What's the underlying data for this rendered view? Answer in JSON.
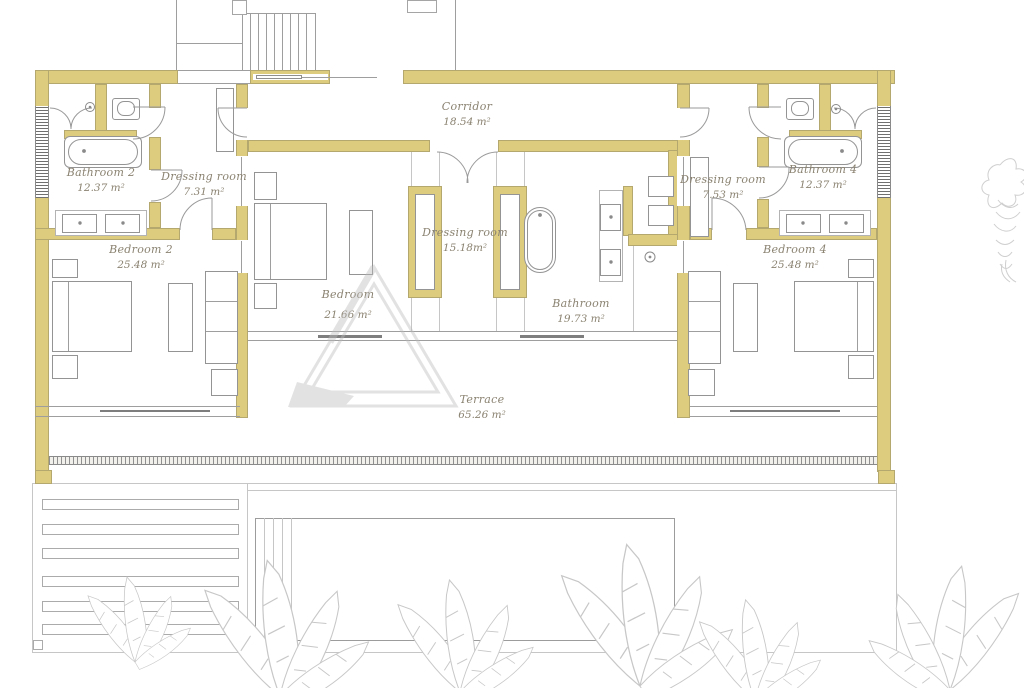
{
  "plan_title": "floor-plan",
  "rooms": [
    {
      "id": "corridor",
      "name": "Corridor",
      "area": "18.54 m²"
    },
    {
      "id": "bathroom-2",
      "name": "Bathroom 2",
      "area": "12.37 m²"
    },
    {
      "id": "dressing-room-2",
      "name": "Dressing room",
      "area": "7.31 m²"
    },
    {
      "id": "bedroom-2",
      "name": "Bedroom 2",
      "area": "25.48 m²"
    },
    {
      "id": "dressing-master",
      "name": "Dressing room",
      "area": "15.18m²"
    },
    {
      "id": "bedroom-3",
      "name": "Bedroom",
      "area": "21.66 m²"
    },
    {
      "id": "bathroom-master",
      "name": "Bathroom",
      "area": "19.73 m²"
    },
    {
      "id": "dressing-room-4",
      "name": "Dressing room",
      "area": "7.53 m²"
    },
    {
      "id": "bathroom-4",
      "name": "Bathroom 4",
      "area": "12.37 m²"
    },
    {
      "id": "bedroom-4",
      "name": "Bedroom 4",
      "area": "25.48 m²"
    },
    {
      "id": "terrace",
      "name": "Terrace",
      "area": "65.26 m²"
    }
  ],
  "colors": {
    "wall_fill": "#ddcb7e",
    "wall_edge": "#b5a86f",
    "drawing_line": "#9a9a9a",
    "label_text": "#8b8372",
    "watermark": "#bcbcbc",
    "plants": "#c7c7c7"
  },
  "watermark_logo": "triangle-monogram"
}
